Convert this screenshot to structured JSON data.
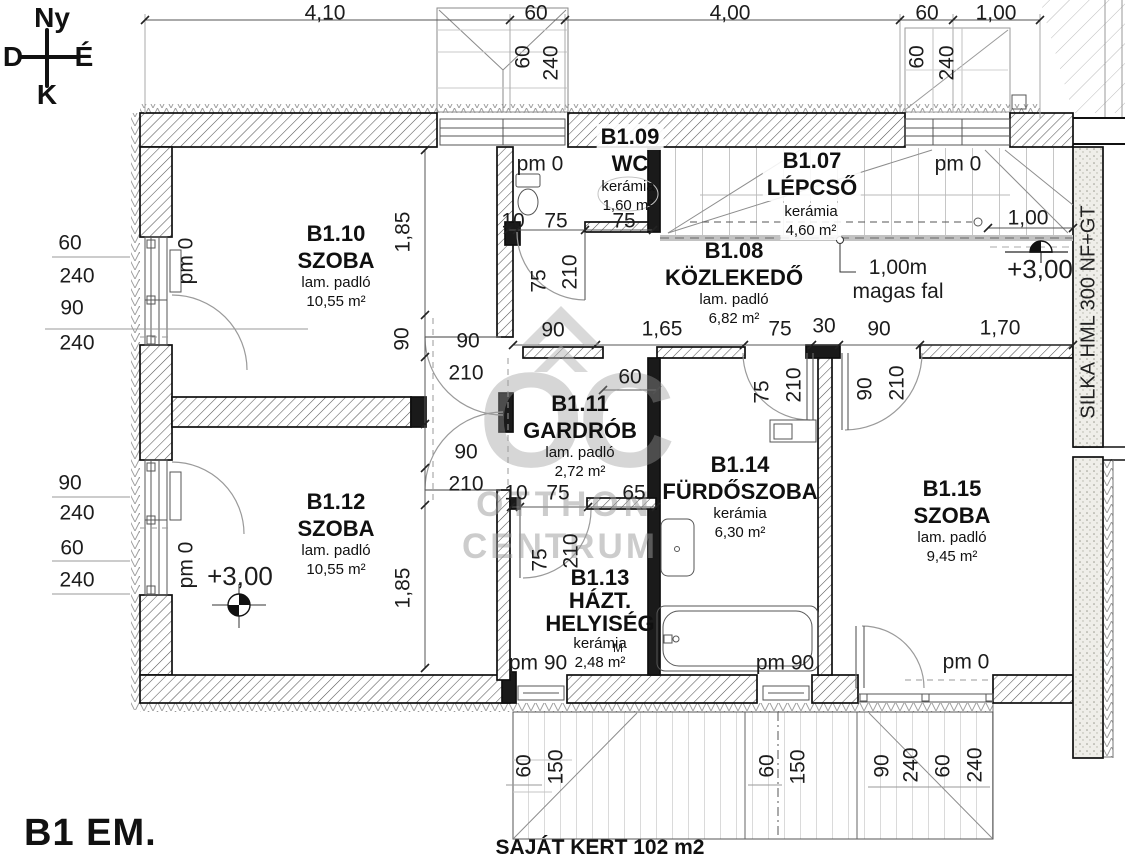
{
  "title": {
    "floor": "B1 EM.",
    "garden": "SAJÁT KERT 102 m2"
  },
  "compass": {
    "top": "Ny",
    "left": "D",
    "right": "É",
    "bottom": "K"
  },
  "watermark": {
    "initials": "OC",
    "line1": "OTTHON",
    "line2": "CENTRUM"
  },
  "wall_material": "SILKA HML 300 NF+GT",
  "note": {
    "line1": "1,00m",
    "line2": "magas fal"
  },
  "rooms": {
    "b107": {
      "id": "B1.07",
      "name": "LÉPCSŐ",
      "floor": "kerámia",
      "area": "4,60 m²"
    },
    "b108": {
      "id": "B1.08",
      "name": "KÖZLEKEDŐ",
      "floor": "lam. padló",
      "area": "6,82 m²"
    },
    "b109": {
      "id": "B1.09",
      "name": "WC",
      "floor": "kerámia",
      "area": "1,60 m²"
    },
    "b110": {
      "id": "B1.10",
      "name": "SZOBA",
      "floor": "lam. padló",
      "area": "10,55 m²"
    },
    "b111": {
      "id": "B1.11",
      "name": "GARDRÓB",
      "floor": "lam. padló",
      "area": "2,72 m²"
    },
    "b112": {
      "id": "B1.12",
      "name": "SZOBA",
      "floor": "lam. padló",
      "area": "10,55 m²"
    },
    "b113": {
      "id": "B1.13",
      "name": "HÁZT.",
      "name2": "HELYISÉG",
      "floor": "kerámia",
      "area": "2,48 m²"
    },
    "b114": {
      "id": "B1.14",
      "name": "FÜRDŐSZOBA",
      "floor": "kerámia",
      "area": "6,30 m²"
    },
    "b115": {
      "id": "B1.15",
      "name": "SZOBA",
      "floor": "lam. padló",
      "area": "9,45 m²"
    }
  },
  "dim_labels": [
    {
      "t": "4,10",
      "x": 325,
      "y": 13
    },
    {
      "t": "60",
      "x": 536,
      "y": 13
    },
    {
      "t": "4,00",
      "x": 730,
      "y": 13
    },
    {
      "t": "60",
      "x": 927,
      "y": 13
    },
    {
      "t": "1,00",
      "x": 996,
      "y": 13
    },
    {
      "t": "60",
      "x": 523,
      "y": 57,
      "r": -90
    },
    {
      "t": "240",
      "x": 551,
      "y": 63,
      "r": -90
    },
    {
      "t": "60",
      "x": 917,
      "y": 57,
      "r": -90
    },
    {
      "t": "240",
      "x": 947,
      "y": 63,
      "r": -90
    },
    {
      "t": "60",
      "x": 70,
      "y": 243
    },
    {
      "t": "240",
      "x": 77,
      "y": 276
    },
    {
      "t": "90",
      "x": 72,
      "y": 308
    },
    {
      "t": "240",
      "x": 77,
      "y": 343
    },
    {
      "t": "90",
      "x": 70,
      "y": 483
    },
    {
      "t": "240",
      "x": 77,
      "y": 513
    },
    {
      "t": "60",
      "x": 72,
      "y": 548
    },
    {
      "t": "240",
      "x": 77,
      "y": 580
    },
    {
      "t": "pm 0",
      "x": 186,
      "y": 261,
      "r": -90,
      "n": "pm-label"
    },
    {
      "t": "pm 0",
      "x": 186,
      "y": 565,
      "r": -90,
      "n": "pm-label"
    },
    {
      "t": "pm 0",
      "x": 540,
      "y": 164,
      "n": "pm-label"
    },
    {
      "t": "pm 0",
      "x": 958,
      "y": 164,
      "n": "pm-label"
    },
    {
      "t": "10",
      "x": 513,
      "y": 221
    },
    {
      "t": "75",
      "x": 556,
      "y": 221
    },
    {
      "t": "75",
      "x": 624,
      "y": 221
    },
    {
      "t": "75",
      "x": 539,
      "y": 281,
      "r": -90
    },
    {
      "t": "210",
      "x": 570,
      "y": 272,
      "r": -90
    },
    {
      "t": "1,00",
      "x": 1028,
      "y": 218
    },
    {
      "t": "90",
      "x": 553,
      "y": 330
    },
    {
      "t": "1,65",
      "x": 662,
      "y": 329
    },
    {
      "t": "75",
      "x": 780,
      "y": 329
    },
    {
      "t": "30",
      "x": 824,
      "y": 326
    },
    {
      "t": "90",
      "x": 879,
      "y": 329
    },
    {
      "t": "1,70",
      "x": 1000,
      "y": 328
    },
    {
      "t": "90",
      "x": 402,
      "y": 339,
      "r": -90
    },
    {
      "t": "90",
      "x": 468,
      "y": 341
    },
    {
      "t": "210",
      "x": 466,
      "y": 373
    },
    {
      "t": "90",
      "x": 466,
      "y": 452
    },
    {
      "t": "210",
      "x": 466,
      "y": 484
    },
    {
      "t": "1,85",
      "x": 403,
      "y": 232,
      "r": -90
    },
    {
      "t": "1,85",
      "x": 403,
      "y": 588,
      "r": -90
    },
    {
      "t": "60",
      "x": 630,
      "y": 377
    },
    {
      "t": "10",
      "x": 516,
      "y": 493
    },
    {
      "t": "75",
      "x": 558,
      "y": 493
    },
    {
      "t": "65",
      "x": 634,
      "y": 493
    },
    {
      "t": "75",
      "x": 540,
      "y": 560,
      "r": -90
    },
    {
      "t": "210",
      "x": 571,
      "y": 551,
      "r": -90
    },
    {
      "t": "75",
      "x": 762,
      "y": 392,
      "r": -90
    },
    {
      "t": "210",
      "x": 794,
      "y": 385,
      "r": -90
    },
    {
      "t": "90",
      "x": 865,
      "y": 389,
      "r": -90
    },
    {
      "t": "210",
      "x": 897,
      "y": 383,
      "r": -90
    },
    {
      "t": "pm 90",
      "x": 538,
      "y": 663,
      "n": "pm-label"
    },
    {
      "t": "pm 90",
      "x": 785,
      "y": 663,
      "n": "pm-label"
    },
    {
      "t": "pm 0",
      "x": 966,
      "y": 662,
      "n": "pm-label"
    },
    {
      "t": "60",
      "x": 524,
      "y": 766,
      "r": -90
    },
    {
      "t": "150",
      "x": 556,
      "y": 767,
      "r": -90
    },
    {
      "t": "60",
      "x": 767,
      "y": 766,
      "r": -90
    },
    {
      "t": "150",
      "x": 798,
      "y": 767,
      "r": -90
    },
    {
      "t": "90",
      "x": 882,
      "y": 766,
      "r": -90
    },
    {
      "t": "240",
      "x": 911,
      "y": 765,
      "r": -90
    },
    {
      "t": "60",
      "x": 943,
      "y": 766,
      "r": -90
    },
    {
      "t": "240",
      "x": 975,
      "y": 765,
      "r": -90
    },
    {
      "t": "+3,00",
      "x": 240,
      "y": 576,
      "s": 26,
      "n": "level-label"
    },
    {
      "t": "+3,00",
      "x": 1040,
      "y": 269,
      "s": 26,
      "n": "level-label"
    },
    {
      "t": "M",
      "x": 618,
      "y": 648,
      "s": 12,
      "n": "appliance-label"
    }
  ]
}
